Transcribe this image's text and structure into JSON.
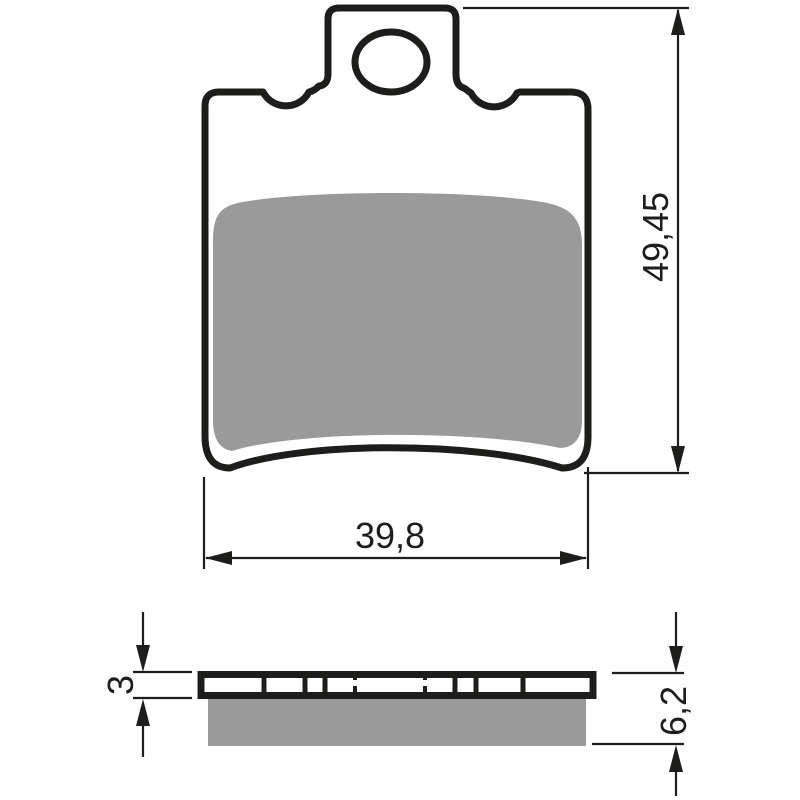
{
  "drawing": {
    "type": "technical-drawing",
    "subject": "brake-pad",
    "views": {
      "front": {
        "dim_height_label": "49,45",
        "dim_width_label": "39,8"
      },
      "side": {
        "dim_backing_thickness_label": "3",
        "dim_total_thickness_label": "6,2"
      }
    }
  },
  "colors": {
    "outline": "#1d1d1b",
    "friction_gray": "#9a9a9a",
    "background": "#ffffff"
  }
}
